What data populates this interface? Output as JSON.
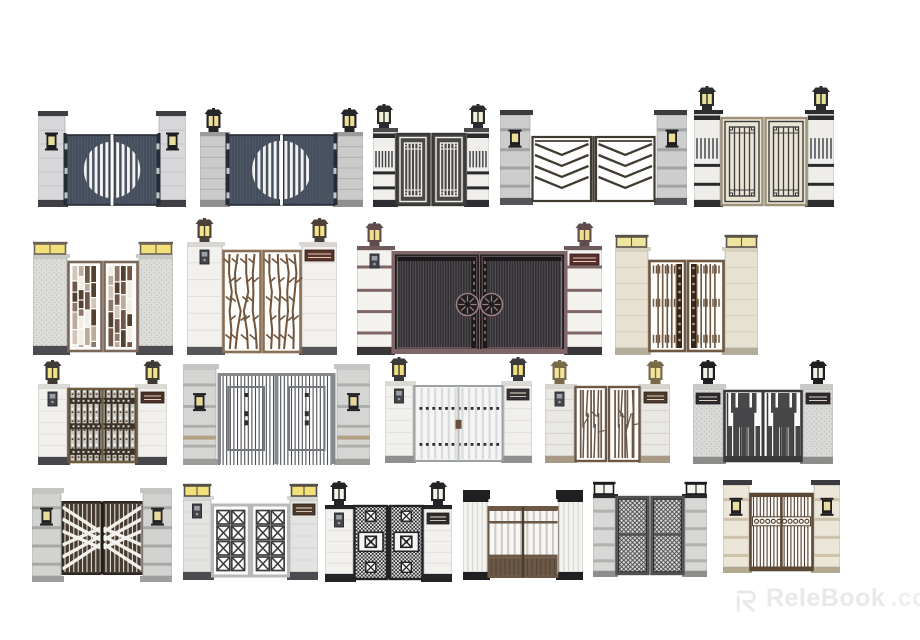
{
  "page": {
    "background": "#ffffff",
    "width": 920,
    "height": 640
  },
  "watermark": {
    "brand": "ReleBook",
    "suffix": ".com",
    "color": "#e9e9e9",
    "logo": "relebook-r-icon"
  },
  "gates": [
    {
      "name": "gate-dark-circle-slat-doors-wall-lamps",
      "x": 38,
      "y": 111,
      "w": 148,
      "h": 96,
      "pillar": {
        "w": 27,
        "fill": "#d8d8db",
        "band": "#bcbcbf",
        "cap": "#3e3e44",
        "base": "#3e3e44",
        "style": "seams",
        "lamp": "wall",
        "lampFrame": "#1e1e21",
        "lampGlass": "#e9dd9b",
        "lampY": 0.22
      },
      "door": {
        "top": 24,
        "bot": 2,
        "frame": "#262b35",
        "fill": "#454e5d",
        "accent": "#535c6c",
        "pattern": "circle-stripes"
      }
    },
    {
      "name": "gate-dark-circle-slat-doors-lantern-pillars",
      "x": 200,
      "y": 108,
      "w": 163,
      "h": 99,
      "pillar": {
        "w": 27,
        "fill": "#cbcbcb",
        "band": "#adadad",
        "cap": "#9b9b9b",
        "capH": 4,
        "base": "#8f8f8f",
        "style": "seams",
        "lamp": "top",
        "lampFrame": "#26262a",
        "lampGlass": "#ecdf93"
      },
      "door": {
        "top": 27,
        "bot": 2,
        "frame": "#262b35",
        "fill": "#454e5d",
        "accent": "#535c6c",
        "pattern": "circle-stripes"
      }
    },
    {
      "name": "gate-white-lattice-doors",
      "x": 373,
      "y": 104,
      "w": 116,
      "h": 103,
      "pillar": {
        "w": 22,
        "fill": "#f0efec",
        "band": "#d8d7d3",
        "cap": "#4a4a4e",
        "capH": 4,
        "base": "#2e2e32",
        "style": "blackband",
        "lamp": "top",
        "lampFrame": "#2b2b2e",
        "lampGlass": "#f3f0d8"
      },
      "door": {
        "top": 30,
        "bot": 2,
        "frame": "#3a3835",
        "fill": "#4a4845",
        "accent": "#f0efea",
        "pattern": "lattice"
      }
    },
    {
      "name": "gate-chevron-bar-doors",
      "x": 500,
      "y": 110,
      "w": 187,
      "h": 95,
      "pillar": {
        "w": 30,
        "fill": "#cdcdcd",
        "band": "#a3a3a3",
        "cap": "#3c3c41",
        "base": "#55555a",
        "style": "banded",
        "lamp": "wall",
        "lampFrame": "#1d1d20",
        "lampGlass": "#eadd96",
        "lampY": 0.2
      },
      "door": {
        "top": 26,
        "bot": 3,
        "frame": "#403b31",
        "fill": "#fdfdfc",
        "accent": "#403b31",
        "pattern": "chevron"
      }
    },
    {
      "name": "gate-dark-lattice-cream-doors",
      "x": 694,
      "y": 86,
      "w": 140,
      "h": 121,
      "pillar": {
        "w": 26,
        "fill": "#efede9",
        "band": "#d9d6d0",
        "cap": "#2d2d30",
        "capH": 4,
        "base": "#2d2d30",
        "style": "blackband",
        "lamp": "top",
        "lampFrame": "#2b2b2e",
        "lampGlass": "#e7e39a"
      },
      "door": {
        "top": 32,
        "bot": 2,
        "frame": "#9c9078",
        "fill": "#eae4d4",
        "accent": "#3d3d3f",
        "pattern": "lattice"
      }
    },
    {
      "name": "gate-brown-mosaic-doors",
      "x": 33,
      "y": 241,
      "w": 140,
      "h": 114,
      "pillar": {
        "w": 34,
        "fill": "#dcdcd9",
        "band": "#c6c6c3",
        "cap": "#c9c9c5",
        "capH": 4,
        "base": "#4b4b50",
        "baseH": 9,
        "style": "granite",
        "lamp": "box",
        "lampFrame": "#6b6258",
        "lampGlass": "#f2e178"
      },
      "door": {
        "top": 21,
        "bot": 4,
        "frame": "#7a685a",
        "fill": "#fdfcfa",
        "accent": "#6f5646",
        "pattern": "mosaic"
      }
    },
    {
      "name": "gate-branch-lattice-doors",
      "x": 187,
      "y": 218,
      "w": 150,
      "h": 137,
      "pillar": {
        "w": 35,
        "fill": "#f2f1ee",
        "band": "#dddbd6",
        "cap": "#d9d7d1",
        "capH": 4,
        "base": "#55555a",
        "baseH": 8,
        "style": "seams",
        "lamp": "top",
        "lampFrame": "#4a4138",
        "lampGlass": "#f4e387",
        "plaques": [
          "right"
        ],
        "plaqueColor": "#5b332b",
        "intercoms": [
          "left"
        ]
      },
      "door": {
        "top": 33,
        "bot": 3,
        "frame": "#8a6f55",
        "fill": "#fdfdfb",
        "accent": "#70543c",
        "pattern": "branches"
      }
    },
    {
      "name": "gate-grand-slat-doors-medallions",
      "x": 357,
      "y": 222,
      "w": 245,
      "h": 133,
      "pillar": {
        "w": 35,
        "fill": "#f3f2ef",
        "band": "#7e6668",
        "cap": "#6e595b",
        "capH": 4,
        "base": "#393438",
        "baseH": 8,
        "style": "banded",
        "lamp": "top",
        "lampFrame": "#5f4c4e",
        "lampGlass": "#f2df85",
        "plaques": [
          "right"
        ],
        "plaqueColor": "#5b2e2e",
        "intercoms": [
          "left"
        ]
      },
      "door": {
        "top": 31,
        "bot": 3,
        "frame": "#7e6668",
        "fill": "#322f32",
        "accent": "#57525a",
        "pattern": "slats-medallion"
      }
    },
    {
      "name": "gate-bar-doors-ornament-strips",
      "x": 615,
      "y": 234,
      "w": 143,
      "h": 121,
      "pillar": {
        "w": 33,
        "fill": "#e7e1d1",
        "band": "#d2ccba",
        "cap": "#d8d1bf",
        "capH": 4,
        "base": "#b4ad99",
        "style": "seams",
        "lamp": "box",
        "lampFrame": "#5a5348",
        "lampGlass": "#f0e5a0"
      },
      "door": {
        "top": 27,
        "bot": 4,
        "frame": "#6f5741",
        "fill": "#fdfdfb",
        "accent": "#6f5741",
        "pattern": "bars-ornate"
      }
    },
    {
      "name": "gate-dense-wrought-iron-doors",
      "x": 38,
      "y": 360,
      "w": 129,
      "h": 105,
      "pillar": {
        "w": 29,
        "fill": "#f1f0ed",
        "band": "#dedcd7",
        "cap": "#dcdad4",
        "capH": 4,
        "base": "#47474b",
        "baseH": 8,
        "style": "seams",
        "lamp": "top",
        "lampFrame": "#3f3a33",
        "lampGlass": "#f2e385",
        "plaques": [
          "right"
        ],
        "plaqueColor": "#4c2f27",
        "intercoms": [
          "left"
        ]
      },
      "door": {
        "top": 29,
        "bot": 3,
        "frame": "#6d5a3f",
        "fill": "#cdc9c0",
        "accent": "#2f2c27",
        "pattern": "dense-iron"
      }
    },
    {
      "name": "gate-gray-bar-fence-doors",
      "x": 183,
      "y": 364,
      "w": 187,
      "h": 101,
      "pillar": {
        "w": 33,
        "fill": "#d5d5d3",
        "band": "#aeaeac",
        "cap": "#c6c6c4",
        "capH": 5,
        "base": "#9c9c9a",
        "baseH": 6,
        "style": "banded",
        "tanBand": "#b2a183",
        "lamp": "wall",
        "lampFrame": "#222225",
        "lampGlass": "#e4d79a",
        "lampY": 0.29
      },
      "door": {
        "top": 9,
        "bot": 1,
        "frame": "#85898c",
        "fill": "#fcfcfc",
        "accent": "#4b4f53",
        "pattern": "bars-frame"
      }
    },
    {
      "name": "gate-white-slat-doors-square-studs",
      "x": 385,
      "y": 357,
      "w": 147,
      "h": 106,
      "pillar": {
        "w": 28,
        "fill": "#f1f0ed",
        "band": "#dedcd7",
        "cap": "#dcdad4",
        "capH": 4,
        "base": "#8f8f8d",
        "style": "seams",
        "lamp": "top",
        "lampFrame": "#3b3b3e",
        "lampGlass": "#f2e178",
        "plaques": [
          "right"
        ],
        "plaqueColor": "#333336",
        "intercoms": [
          "left"
        ]
      },
      "door": {
        "top": 29,
        "bot": 2,
        "frame": "#9aa0a3",
        "fill": "#f4f4f2",
        "accent": "#2e2e32",
        "pattern": "slats-squares"
      }
    },
    {
      "name": "gate-irregular-stick-doors",
      "x": 545,
      "y": 360,
      "w": 125,
      "h": 103,
      "pillar": {
        "w": 29,
        "fill": "#eae8e3",
        "band": "#d2cfc8",
        "cap": "#d8d5ce",
        "capH": 4,
        "base": "#a89a84",
        "style": "seams",
        "lamp": "top",
        "lampFrame": "#7a6a4a",
        "lampGlass": "#f0e59a",
        "plaques": [
          "right"
        ],
        "plaqueColor": "#4c3a2c",
        "intercoms": [
          "left"
        ]
      },
      "door": {
        "top": 27,
        "bot": 2,
        "frame": "#6b5747",
        "fill": "#fdfdfb",
        "accent": "#6b5747",
        "pattern": "sticks"
      }
    },
    {
      "name": "gate-skyline-silhouette-doors",
      "x": 693,
      "y": 360,
      "w": 140,
      "h": 104,
      "pillar": {
        "w": 30,
        "fill": "#d9d9d7",
        "band": "#b3b3b1",
        "cap": "#c9c9c7",
        "capH": 5,
        "base": "#8c8c8a",
        "style": "granite",
        "lamp": "top",
        "lampFrame": "#1f1f22",
        "lampGlass": "#f1f1e6",
        "plaques": [
          "left",
          "right"
        ],
        "plaqueColor": "#2b2b2f"
      },
      "door": {
        "top": 31,
        "bot": 3,
        "frame": "#3a3a3d",
        "fill": "#fbfbfa",
        "accent": "#474749",
        "pattern": "skyline"
      }
    },
    {
      "name": "gate-diagonal-stripe-doors",
      "x": 32,
      "y": 488,
      "w": 140,
      "h": 94,
      "pillar": {
        "w": 29,
        "fill": "#d2d2d0",
        "band": "#a7a7a5",
        "cap": "#c4c4c2",
        "capH": 5,
        "base": "#9e9e9c",
        "baseH": 6,
        "style": "banded",
        "lamp": "wall",
        "lampFrame": "#222225",
        "lampGlass": "#e8dc9a",
        "lampY": 0.2
      },
      "door": {
        "top": 14,
        "bot": 8,
        "frame": "#2f2822",
        "fill": "#473c31",
        "accent": "#f3f1ec",
        "pattern": "diag-stripes"
      }
    },
    {
      "name": "gate-x-lattice-doors",
      "x": 183,
      "y": 483,
      "w": 135,
      "h": 97,
      "pillar": {
        "w": 28,
        "fill": "#e3e3e1",
        "band": "#cfcfcd",
        "cap": "#d6d6d4",
        "capH": 4,
        "base": "#4c4c50",
        "baseH": 8,
        "style": "seams",
        "lamp": "box",
        "lampFrame": "#55504a",
        "lampGlass": "#f2e178",
        "plaques": [
          "right"
        ],
        "plaqueColor": "#4c3a2c",
        "intercoms": [
          "left"
        ]
      },
      "door": {
        "top": 22,
        "bot": 4,
        "frame": "#b7b8ba",
        "fill": "#fdfdfd",
        "accent": "#3d3d40",
        "pattern": "x-squares"
      }
    },
    {
      "name": "gate-black-fretwork-doors",
      "x": 325,
      "y": 481,
      "w": 127,
      "h": 101,
      "pillar": {
        "w": 28,
        "fill": "#f2f1ee",
        "band": "#e0dedb",
        "cap": "#242427",
        "capH": 4,
        "base": "#242427",
        "baseH": 8,
        "style": "seams",
        "lamp": "top",
        "lampFrame": "#242427",
        "lampGlass": "#f2f2ea",
        "plaques": [
          "right"
        ],
        "plaqueColor": "#2c2c2e",
        "intercoms": [
          "left"
        ]
      },
      "door": {
        "top": 25,
        "bot": 3,
        "frame": "#232325",
        "fill": "#ececec",
        "accent": "#2e2e30",
        "pattern": "ornate-black"
      }
    },
    {
      "name": "gate-white-slat-doors-column-pillars",
      "x": 463,
      "y": 490,
      "w": 120,
      "h": 90,
      "pillar": {
        "w": 24,
        "fill": "#f4f3f0",
        "band": "#d9d7d2",
        "cap": "#1f1f22",
        "capH": 9,
        "base": "#1f1f22",
        "baseH": 8,
        "style": "column",
        "lamp": "none"
      },
      "door": {
        "top": 17,
        "bot": 3,
        "frame": "#6b5847",
        "fill": "#f7f6f4",
        "accent": "#ccc9c3",
        "pattern": "slat-columns"
      }
    },
    {
      "name": "gate-diagonal-mesh-doors",
      "x": 593,
      "y": 481,
      "w": 114,
      "h": 96,
      "pillar": {
        "w": 22,
        "fill": "#d7d7d5",
        "band": "#b1b1af",
        "cap": "#2a2a2d",
        "capH": 4,
        "base": "#8e8e8c",
        "baseH": 6,
        "style": "banded",
        "lamp": "box",
        "lampFrame": "#1b1b1d",
        "lampGlass": "#f4f4ef"
      },
      "door": {
        "top": 16,
        "bot": 3,
        "frame": "#515154",
        "fill": "#dadada",
        "accent": "#454549",
        "pattern": "diag-mesh"
      }
    },
    {
      "name": "gate-bar-doors-scroll-band",
      "x": 723,
      "y": 480,
      "w": 117,
      "h": 93,
      "pillar": {
        "w": 26,
        "fill": "#ece6d8",
        "band": "#cec3aa",
        "cap": "#3b3b3f",
        "capH": 5,
        "base": "#b2a890",
        "baseH": 6,
        "style": "banded",
        "lamp": "wall",
        "lampFrame": "#1e1e21",
        "lampGlass": "#e9dd9b",
        "lampY": 0.18
      },
      "door": {
        "top": 14,
        "bot": 3,
        "frame": "#5c4836",
        "fill": "#fdfcfa",
        "accent": "#53402e",
        "pattern": "bars-scroll"
      }
    }
  ]
}
